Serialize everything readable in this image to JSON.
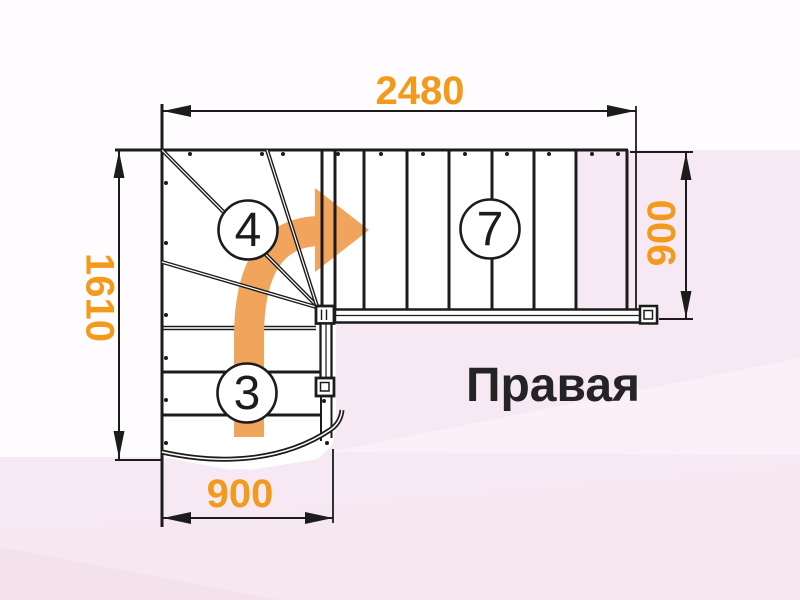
{
  "drawing": {
    "title_label": "Правая",
    "dimensions": {
      "top": "2480",
      "left": "1610",
      "right": "900",
      "bottom": "900"
    },
    "step_counts": {
      "winder_flight": "4",
      "upper_flight": "7",
      "lower_flight": "3"
    },
    "colors": {
      "dimension_text": "#F29A1B",
      "arrow": "#F0A45C",
      "line": "#1C1C1C",
      "title": "#242424",
      "background_pink": "#F7E9F3"
    }
  }
}
